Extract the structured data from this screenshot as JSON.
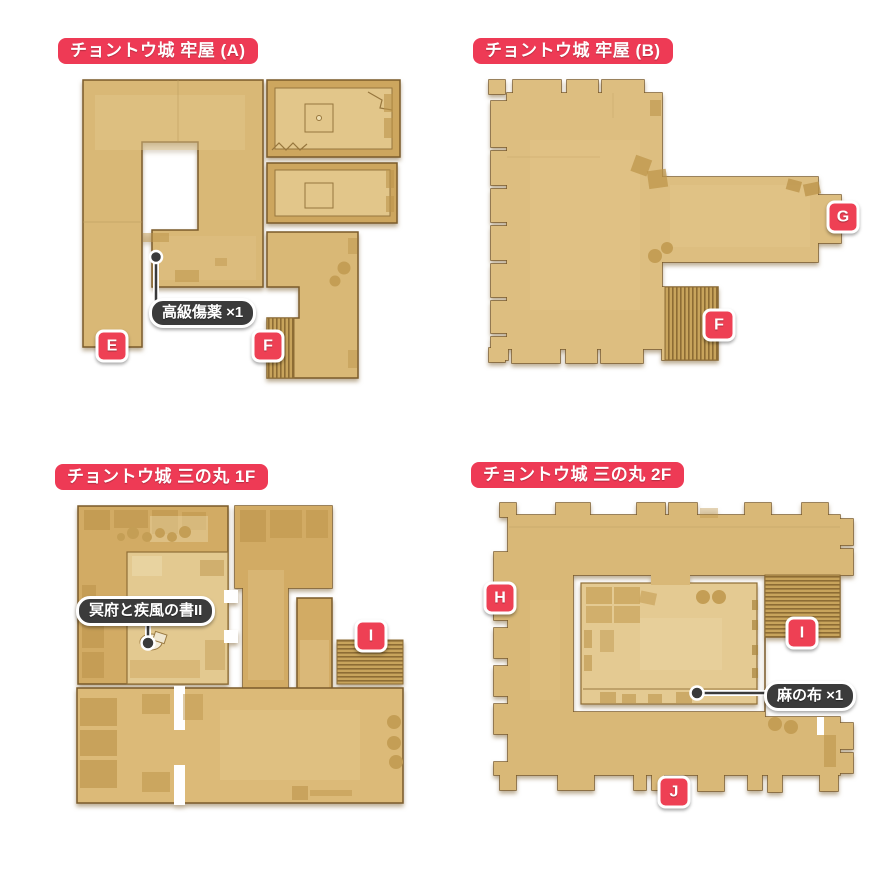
{
  "colors": {
    "accent_red_title": "#ee3a55",
    "accent_red_badge": "#ee4054",
    "label_dark": "#3b3b3b",
    "floor_tan": "#d9b876",
    "floor_dark": "#cda65e",
    "floor_light": "#e4ca92",
    "outline_brown": "#7b5b2a"
  },
  "maps": [
    {
      "title": "チョントウ城 牢屋 (A)",
      "badges": [
        {
          "letter": "E"
        },
        {
          "letter": "F"
        }
      ],
      "items": [
        {
          "label": "高級傷薬 ×1"
        }
      ]
    },
    {
      "title": "チョントウ城 牢屋 (B)",
      "badges": [
        {
          "letter": "G"
        },
        {
          "letter": "F"
        }
      ],
      "items": []
    },
    {
      "title": "チョントウ城 三の丸 1F",
      "badges": [
        {
          "letter": "I"
        }
      ],
      "items": [
        {
          "label": "冥府と疾風の書II"
        }
      ]
    },
    {
      "title": "チョントウ城 三の丸 2F",
      "badges": [
        {
          "letter": "H"
        },
        {
          "letter": "I"
        },
        {
          "letter": "J"
        }
      ],
      "items": [
        {
          "label": "麻の布 ×1"
        }
      ]
    }
  ]
}
